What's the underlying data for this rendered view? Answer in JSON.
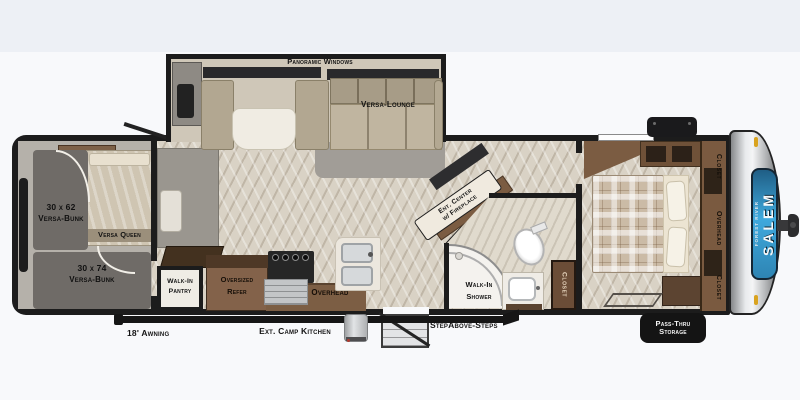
{
  "plan": {
    "brand": "Salem",
    "brand_sub": "Forest River",
    "slideout": {
      "window_label": "Panoramic Windows",
      "lounge": "Versa-Lounge"
    },
    "bunkroom": {
      "bunk_top_size": "30 x 62",
      "bunk_top": "Versa-Bunk",
      "queen": "Versa Queen",
      "bunk_bottom_size": "30 x 74",
      "bunk_bottom": "Versa-Bunk"
    },
    "kitchen": {
      "pantry_line1": "Walk-In",
      "pantry_line2": "Pantry",
      "refer_line1": "Oversized",
      "refer_line2": "Refer",
      "overhead": "Overhead"
    },
    "living": {
      "ent_line1": "Ent. Center",
      "ent_line2": "w/ Fireplace"
    },
    "bath": {
      "shower_line1": "Walk-In",
      "shower_line2": "Shower",
      "closet": "Closet"
    },
    "bedroom": {
      "closet_top": "Closet",
      "overhead": "Overhead",
      "closet_bottom": "Closet"
    },
    "exterior": {
      "awning": "18' Awning",
      "camp_kitchen": "Ext. Camp Kitchen",
      "steps": "StepAbove-Steps",
      "storage_line1": "Pass-Thru",
      "storage_line2": "Storage"
    },
    "colors": {
      "brand_blue": "#3fa9dd",
      "wall_black": "#1c1c1c",
      "wood_floor": "#d9d2c5",
      "carpet_gray": "#b5b1aa"
    }
  }
}
